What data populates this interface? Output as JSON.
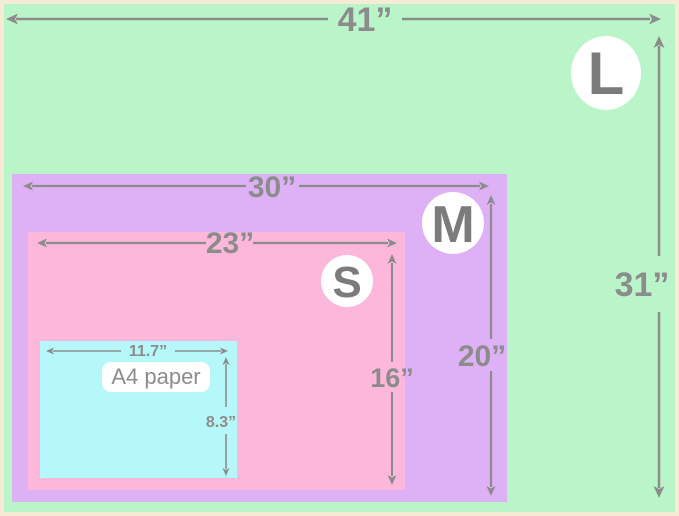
{
  "colors": {
    "frame": "#f6ecd5",
    "size_l": "#baf5ca",
    "size_m": "#deb1f6",
    "size_s": "#fcb7db",
    "a4": "#b6f8fa",
    "dimension": "#8c8c8c",
    "badge_bg": "#ffffff",
    "badge_text": "#7b7b7b",
    "a4_label_bg": "#ffffff",
    "a4_label_text": "#8c8c8c"
  },
  "sizes": [
    {
      "id": "L",
      "badge": "L",
      "width_in": 41,
      "height_in": 31,
      "width_label": "41”",
      "height_label": "31”"
    },
    {
      "id": "M",
      "badge": "M",
      "width_in": 30,
      "height_in": 20,
      "width_label": "30”",
      "height_label": "20”"
    },
    {
      "id": "S",
      "badge": "S",
      "width_in": 23,
      "height_in": 16,
      "width_label": "23”",
      "height_label": "16”"
    },
    {
      "id": "A4",
      "name": "A4 paper",
      "width_in": 11.7,
      "height_in": 8.3,
      "width_label": "11.7”",
      "height_label": "8.3”"
    }
  ]
}
